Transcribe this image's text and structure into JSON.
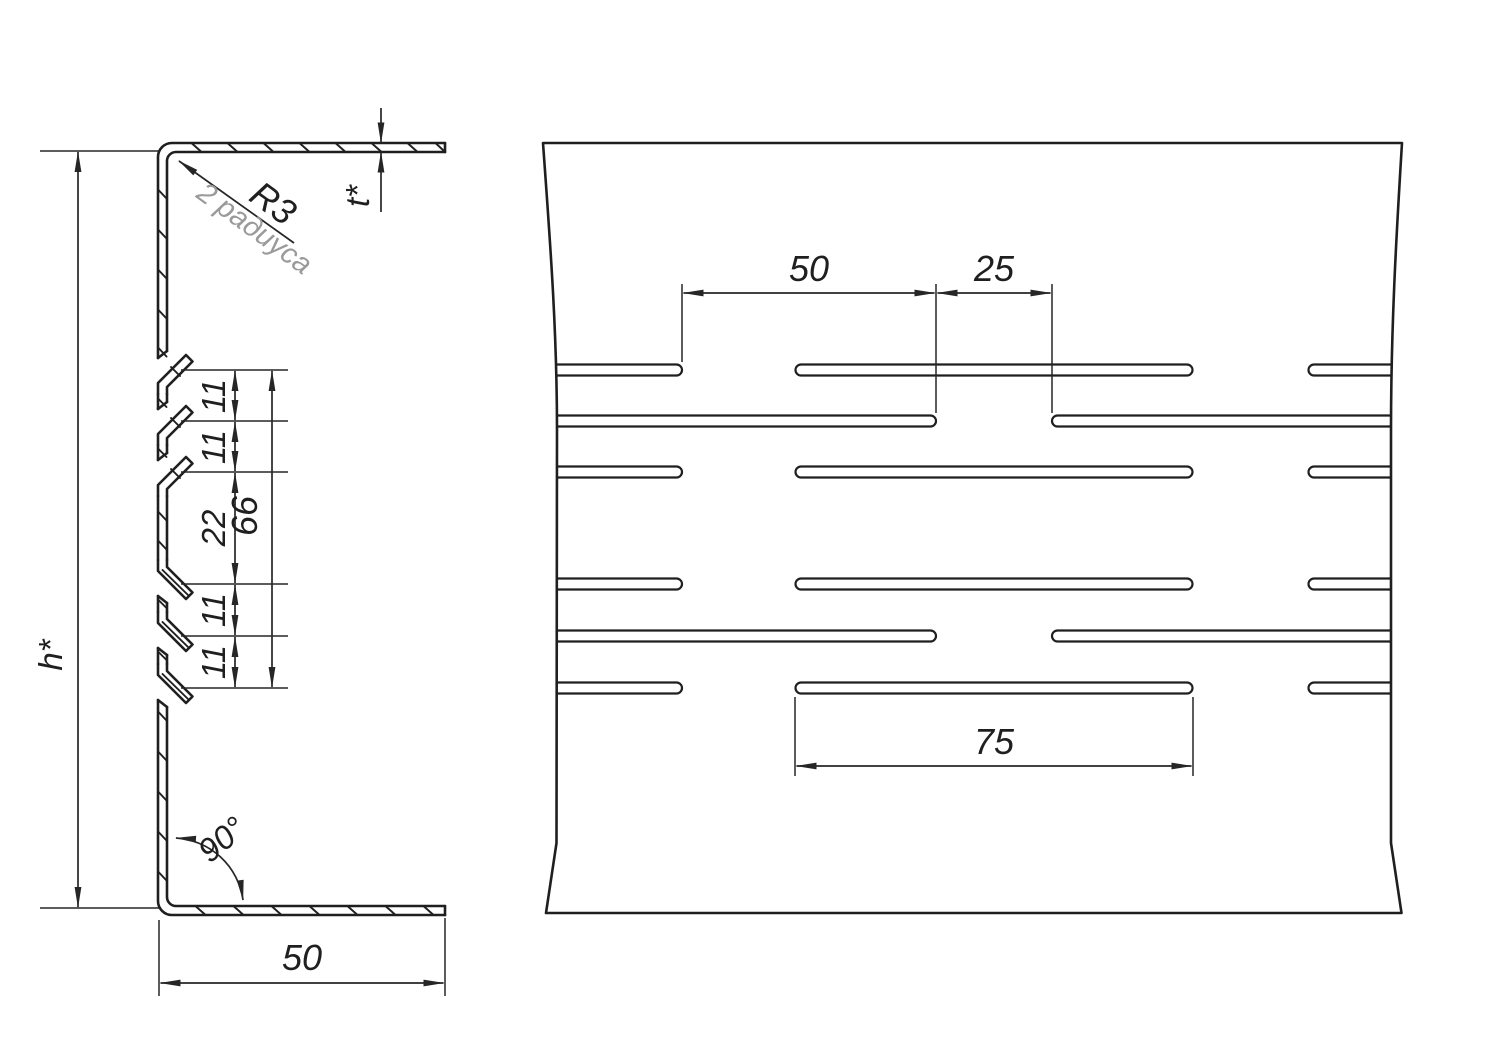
{
  "drawing": {
    "section_view": {
      "radius_label": "R3",
      "radius_note": "2 радиуса",
      "thickness_label": "t*",
      "height_label": "h*",
      "angle_label": "90°",
      "flange_width": "50",
      "notch_chain": [
        "11",
        "11",
        "22",
        "11",
        "11"
      ],
      "notch_span": "66"
    },
    "plan_view": {
      "slot_offset": "50",
      "slot_gap": "25",
      "slot_length": "75"
    },
    "colors": {
      "line": "#1f1f1f",
      "dimension": "#262626",
      "note_gray": "#9a9a9a",
      "background": "#ffffff"
    }
  }
}
